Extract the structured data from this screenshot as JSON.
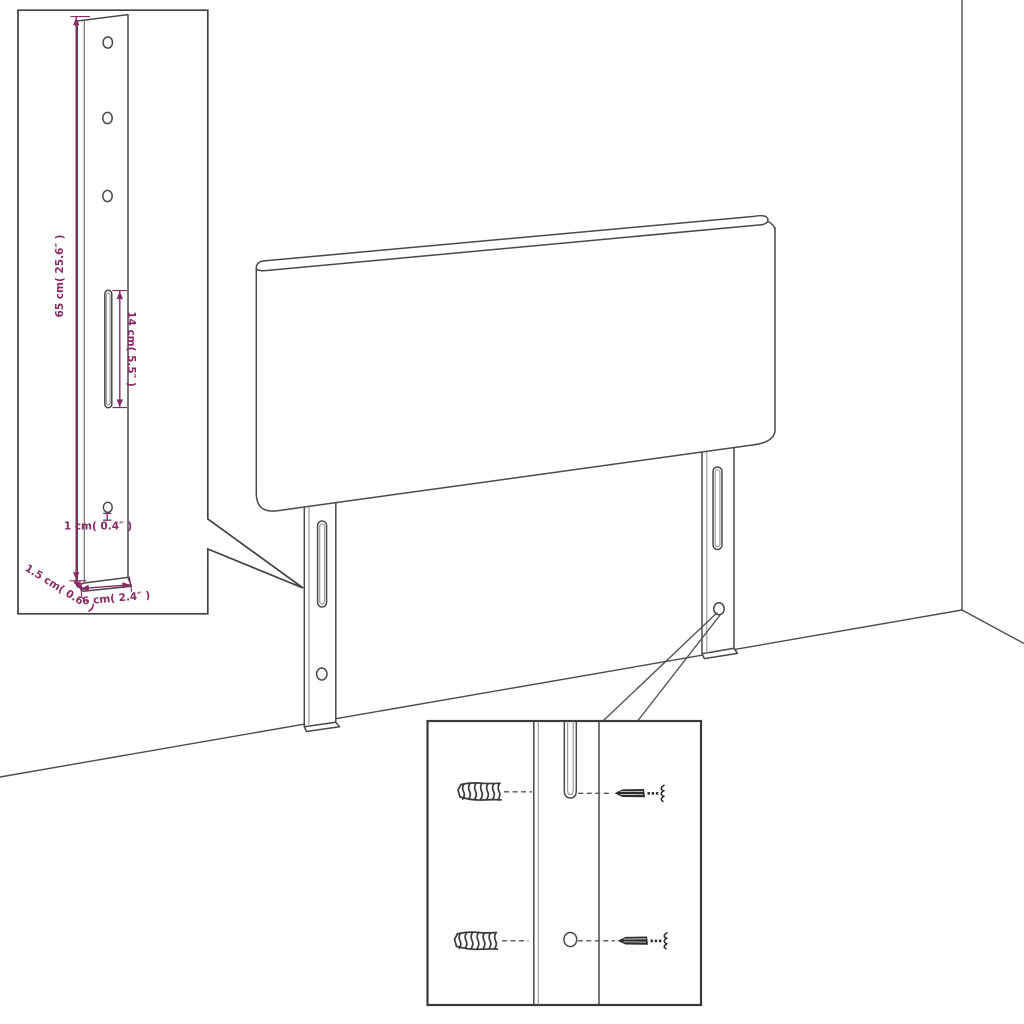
{
  "palette": {
    "line_color": "#4a4a4a",
    "line_light": "#9c9c9c",
    "dimension_color": "#8a2a64",
    "screw_color": "#2c2c2c",
    "background": "#ffffff"
  },
  "leg_detail": {
    "height_label": "65 cm( 25.6″ )",
    "slot_height_label": "14 cm( 5.5″ )",
    "hole_diameter_label": "1 cm( 0.4″ )",
    "thickness_label": "1.5 cm( 0.6″ )",
    "width_label": "6 cm( 2.4″ )"
  }
}
